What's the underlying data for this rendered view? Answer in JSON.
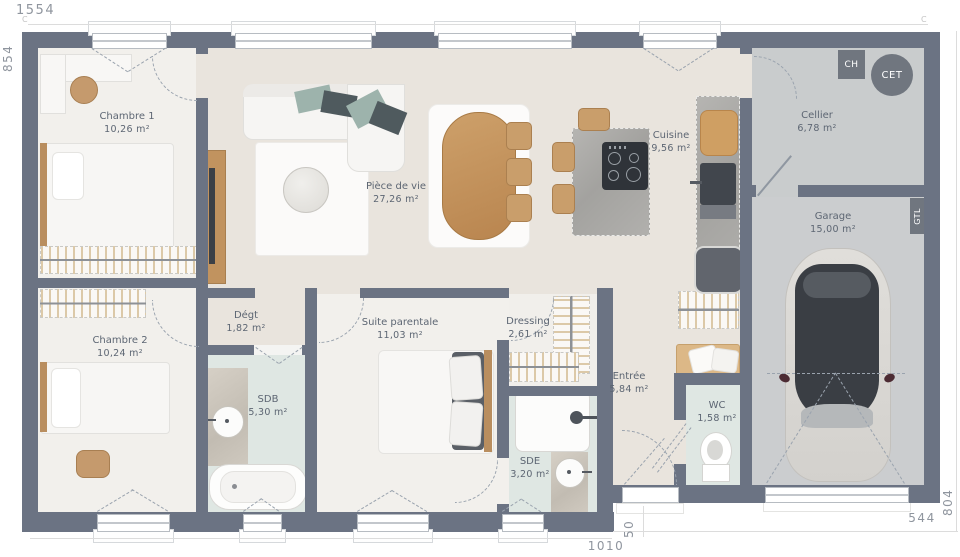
{
  "dimensions": {
    "top": "1554",
    "left": "854",
    "bottom": "1010",
    "step": "50",
    "bottom_right": "544",
    "right": "804",
    "corner_mark": "C"
  },
  "rooms": [
    {
      "name": "Chambre 1",
      "area": "10,26 m²"
    },
    {
      "name": "Chambre 2",
      "area": "10,24 m²"
    },
    {
      "name": "Pièce de vie",
      "area": "27,26 m²"
    },
    {
      "name": "Cuisine",
      "area": "9,56 m²"
    },
    {
      "name": "Cellier",
      "area": "6,78 m²"
    },
    {
      "name": "Garage",
      "area": "15,00 m²"
    },
    {
      "name": "Dégt",
      "area": "1,82 m²"
    },
    {
      "name": "Suite parentale",
      "area": "11,03 m²"
    },
    {
      "name": "SDB",
      "area": "5,30 m²"
    },
    {
      "name": "Dressing",
      "area": "2,61 m²"
    },
    {
      "name": "SDE",
      "area": "3,20 m²"
    },
    {
      "name": "Entrée",
      "area": "5,84 m²"
    },
    {
      "name": "WC",
      "area": "1,58 m²"
    }
  ],
  "labels": {
    "ch": "CH",
    "cet": "CET",
    "gtl": "GTL"
  },
  "colors": {
    "wall": "#6b7383",
    "floor_living": "#e9e4dd",
    "floor_bedroom": "#f2f0ec",
    "floor_bath": "#dfe7e3",
    "floor_cellier": "#c9cccd",
    "floor_garage": "#cbcdcf",
    "wood": "#c99e6b",
    "badge": "#70767f",
    "dim_text": "#8f959e"
  }
}
